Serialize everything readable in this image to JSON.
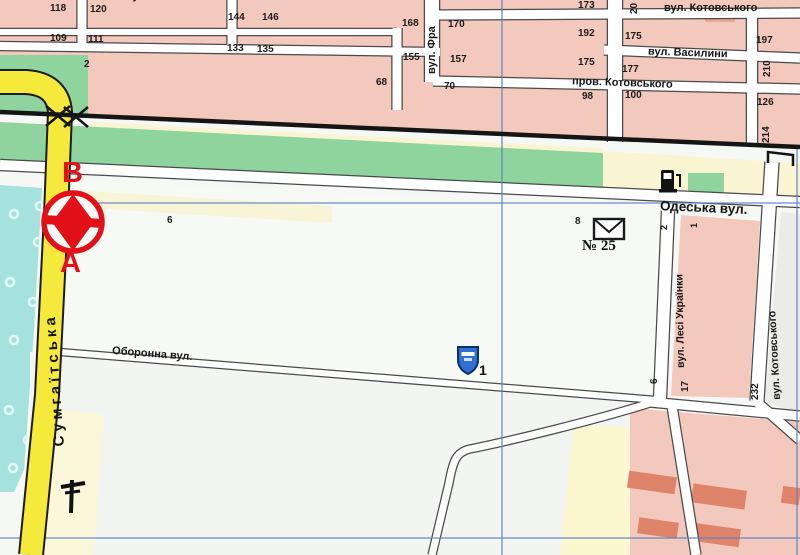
{
  "streets": {
    "kotovskogo_top": "вул. Котовського",
    "vasylyny": "вул. Василини",
    "prov_kotovskogo": "пров. Котовського",
    "franka_partial": "вул. Фра",
    "odeska": "Одеська вул.",
    "lesi_ukrainky": "вул. Лесі Українки",
    "kotovskogo_right": "вул. Котовського",
    "oboronna": "Оборонна вул.",
    "sumgaitska": "Сумгаїтська"
  },
  "house_numbers": {
    "n118": "118",
    "n120": "120",
    "n144": "144",
    "n146": "146",
    "n168": "168",
    "n170": "170",
    "n173": "173",
    "n109": "109",
    "n111": "111",
    "n133": "133",
    "n135": "135",
    "n155": "155",
    "n157": "157",
    "n192": "192",
    "n175a": "175",
    "n175b": "175",
    "n177": "177",
    "n197": "197",
    "n210": "210",
    "n126": "126",
    "n214": "214",
    "n20": "20",
    "n2a": "2",
    "n2b": "2",
    "n68": "68",
    "n70": "70",
    "n98": "98",
    "n100": "100",
    "n6a": "6",
    "n6b": "6",
    "n8": "8",
    "n17": "17",
    "n232": "232",
    "n1a": "1",
    "n1b": "1"
  },
  "poi": {
    "post_office_number": "№ 25",
    "route_label_top": "В",
    "route_label_bottom": "А",
    "shield_number": "1"
  },
  "icons": {
    "route_marker": "route-endpoints-marker-icon",
    "fuel": "fuel-station-icon",
    "post": "post-office-envelope-icon",
    "shield": "shield-marker-icon",
    "mast": "mast-tower-icon",
    "railway": "railway-line",
    "railway_crossing": "railway-crossing-ticks-icon"
  },
  "colors": {
    "block_pink": "#f3c8bd",
    "building_salmon": "#e0836b",
    "park_green": "#8fd39e",
    "water_teal": "#a5e2de",
    "road_yellow": "#f5e93c",
    "sand_cream": "#f9f5d3",
    "grid_blue": "#5b7fc4",
    "marker_red": "#e21118",
    "shield_blue": "#2f6fce",
    "street_white": "#ffffff",
    "block_white": "#f7f9f5",
    "block_gray": "#ebebe8"
  }
}
